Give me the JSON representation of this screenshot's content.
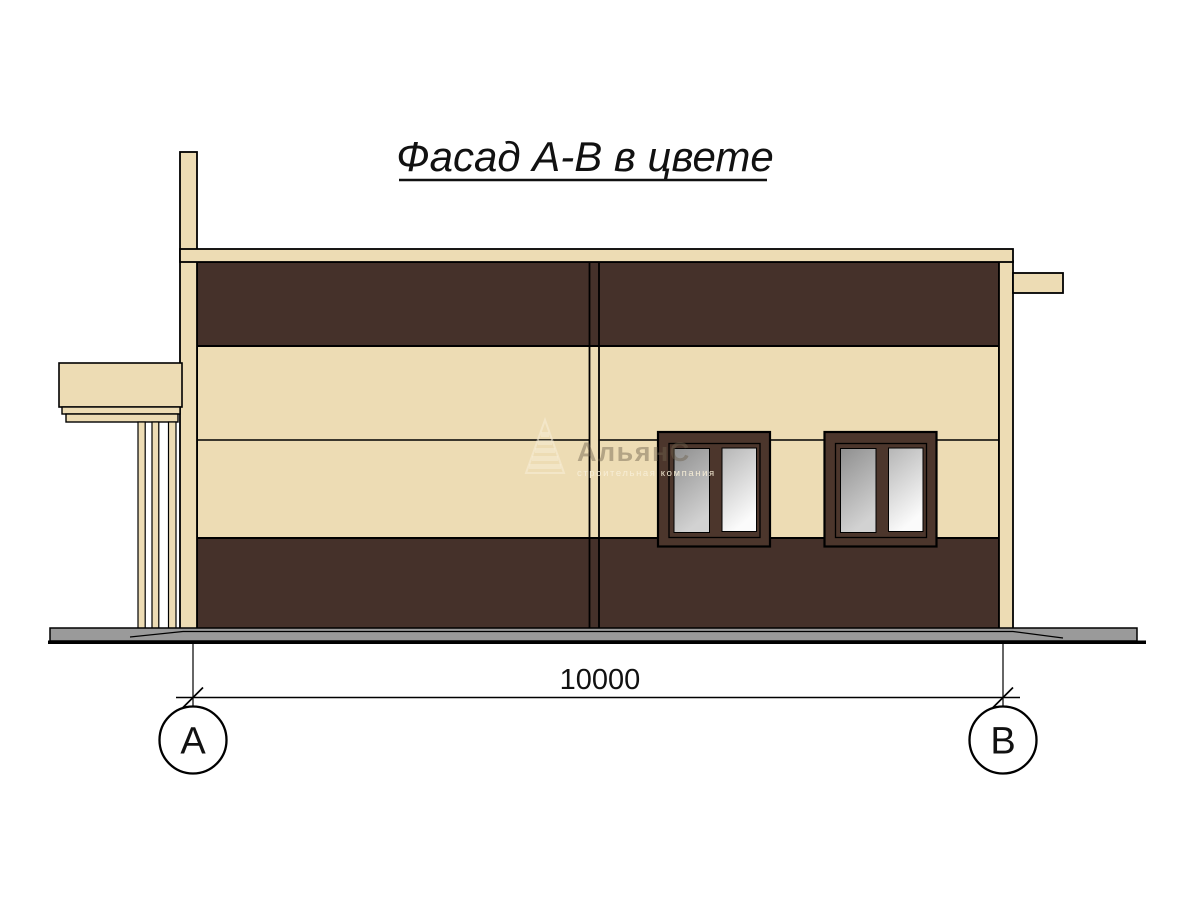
{
  "title": {
    "text": "Фасад А-В в цвете"
  },
  "dimension": {
    "value": "10000"
  },
  "axis_markers": {
    "left": "А",
    "right": "В"
  },
  "watermark": {
    "name": "АльянС",
    "tagline": "строительная компания"
  },
  "colors": {
    "background": "#ffffff",
    "cream": "#eddcb4",
    "brown": "#45312a",
    "window_frame": "#4c362c",
    "ground": "#9a9a9a",
    "outline": "#000000",
    "title_color": "#111111",
    "glass_dark": "#8f8f8f",
    "glass_dark_end": "#d2d2d2",
    "glass_light": "#b5b5b5",
    "glass_light_end": "#fbfbfb",
    "watermark_dark": "#6e614d",
    "watermark_light": "#f8efd8"
  }
}
